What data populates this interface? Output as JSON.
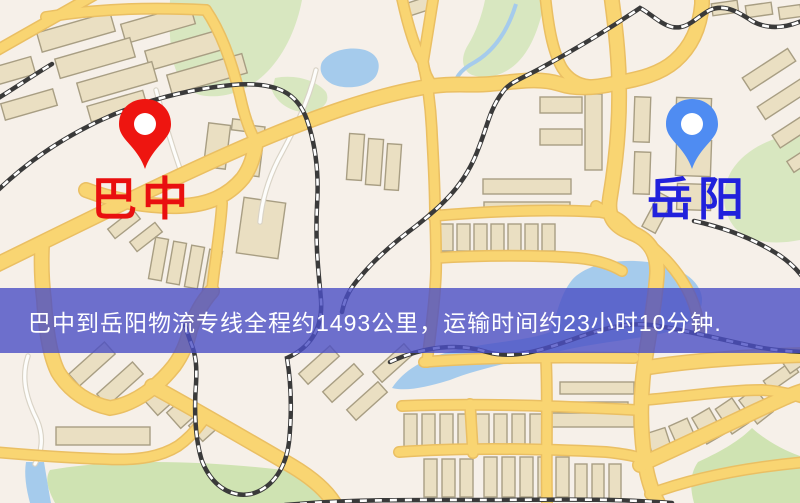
{
  "banner": {
    "text": "巴中到岳阳物流专线全程约1493公里，运输时间约23小时10分钟.",
    "bg_color": "#4b4fc4",
    "text_color": "#ffffff"
  },
  "markers": [
    {
      "id": "origin",
      "label": "巴中",
      "pin_color": "#ee1510",
      "label_color": "#e90f0f"
    },
    {
      "id": "destination",
      "label": "岳阳",
      "pin_color": "#4f8cf2",
      "label_color": "#2121dc"
    }
  ],
  "map": {
    "colors": {
      "background": "#f6f0e9",
      "park": "#d8e7c0",
      "park_dark": "#cfe3b2",
      "water": "#a5cbec",
      "building": "#eadfc2",
      "building_outline": "#a89e83",
      "road": "#f9d572",
      "road_casing": "#eabf63",
      "railway": "#3a3a3a",
      "railway_dash": "#ffffff",
      "minor_road": "#fdfdfb"
    }
  }
}
